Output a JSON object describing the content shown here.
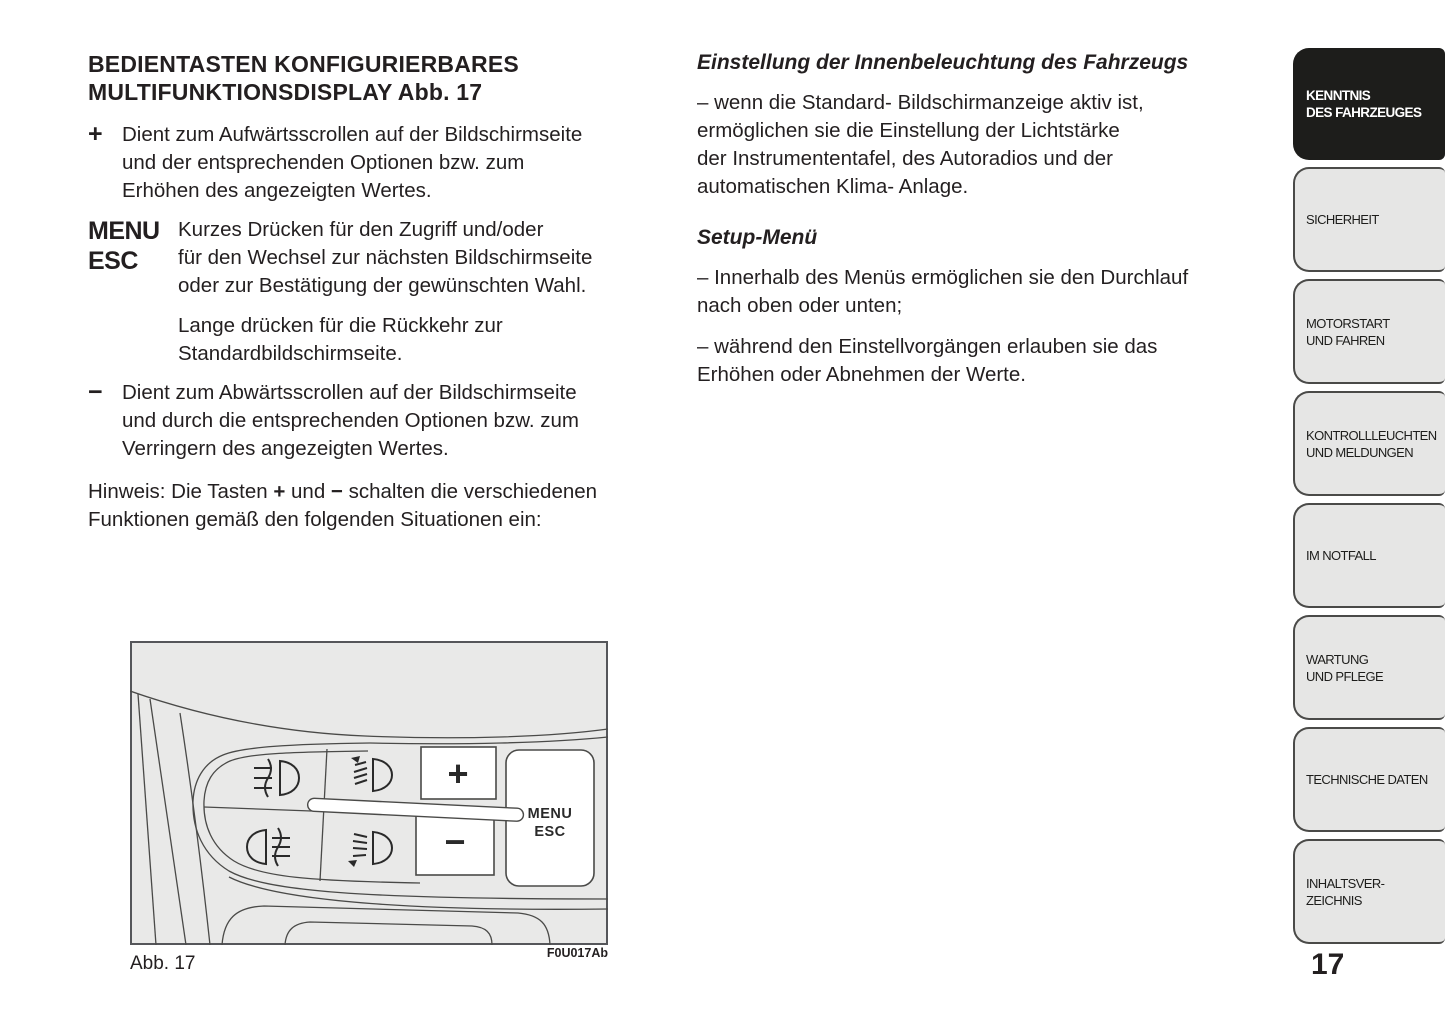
{
  "colors": {
    "text": "#231f20",
    "tab_fill": "#e6e6e5",
    "tab_active_fill": "#1d1d1b",
    "tab_active_text": "#ffffff",
    "figure_bg": "#e9e9e8",
    "line": "#4a4a48"
  },
  "left_column": {
    "heading_lines": [
      "BEDIENTASTEN KONFIGURIERBARES",
      "MULTIFUNKTIONSDISPLAY Abb. 17"
    ],
    "plus_item": {
      "marker": "+",
      "lines": [
        "Dient zum Aufwärtsscrollen auf der Bildschirmseite",
        "und der entsprechenden Optionen bzw. zum",
        "Erhöhen des angezeigten Wertes."
      ]
    },
    "menu_item": {
      "marker_line1": "MENU",
      "marker_line2": "ESC",
      "para1_lines": [
        "Kurzes Drücken für den Zugriff und/oder",
        "für den Wechsel zur nächsten Bildschirmseite",
        "oder zur Bestätigung der gewünschten Wahl."
      ],
      "para2_lines": [
        "Lange drücken für die Rückkehr zur",
        "Standardbildschirmseite."
      ]
    },
    "minus_item": {
      "marker": "−",
      "lines": [
        "Dient zum Abwärtsscrollen auf der Bildschirmseite",
        "und durch die entsprechenden Optionen bzw. zum",
        "Verringern des angezeigten Wertes."
      ]
    },
    "note": {
      "parts": [
        "Hinweis: Die Tasten ",
        "+",
        " und ",
        "−",
        " schalten die verschiedenen"
      ],
      "line2": "Funktionen gemäß den folgenden Situationen ein:"
    }
  },
  "right_column": {
    "section1": {
      "heading": "Einstellung der Innenbeleuchtung des Fahrzeugs",
      "lines": [
        "– wenn die Standard- Bildschirmanzeige aktiv ist,",
        "ermöglichen sie die Einstellung der Lichtstärke",
        "der Instrumententafel, des Autoradios und der",
        "automatischen Klima- Anlage."
      ]
    },
    "section2": {
      "heading": "Setup-Menü",
      "bullet1_lines": [
        "– Innerhalb des Menüs ermöglichen sie den Durchlauf",
        "nach oben oder unten;"
      ],
      "bullet2_lines": [
        "– während den Einstellvorgängen erlauben sie das",
        "Erhöhen oder Abnehmen der Werte."
      ]
    }
  },
  "sidebar": {
    "tabs": [
      {
        "line1": "KENNTNIS",
        "line2": "DES FAHRZEUGES",
        "active": true
      },
      {
        "line1": "SICHERHEIT"
      },
      {
        "line1": "MOTORSTART",
        "line2": "UND FAHREN"
      },
      {
        "line1": "KONTROLLLEUCHTEN",
        "line2": "UND MELDUNGEN"
      },
      {
        "line1": "IM NOTFALL"
      },
      {
        "line1": "WARTUNG",
        "line2": "UND PFLEGE"
      },
      {
        "line1": "TECHNISCHE DATEN"
      },
      {
        "line1": "INHALTSVER-",
        "line2": "ZEICHNIS"
      }
    ]
  },
  "figure": {
    "caption": "Abb. 17",
    "code": "F0U017Ab",
    "buttons": {
      "plus": "+",
      "minus": "−",
      "menu_line1": "MENU",
      "menu_line2": "ESC"
    },
    "icons": [
      "front-fog-light-icon",
      "headlight-leveling-up-icon",
      "rear-fog-light-icon",
      "headlight-leveling-down-icon"
    ]
  },
  "page": {
    "number": "17"
  }
}
